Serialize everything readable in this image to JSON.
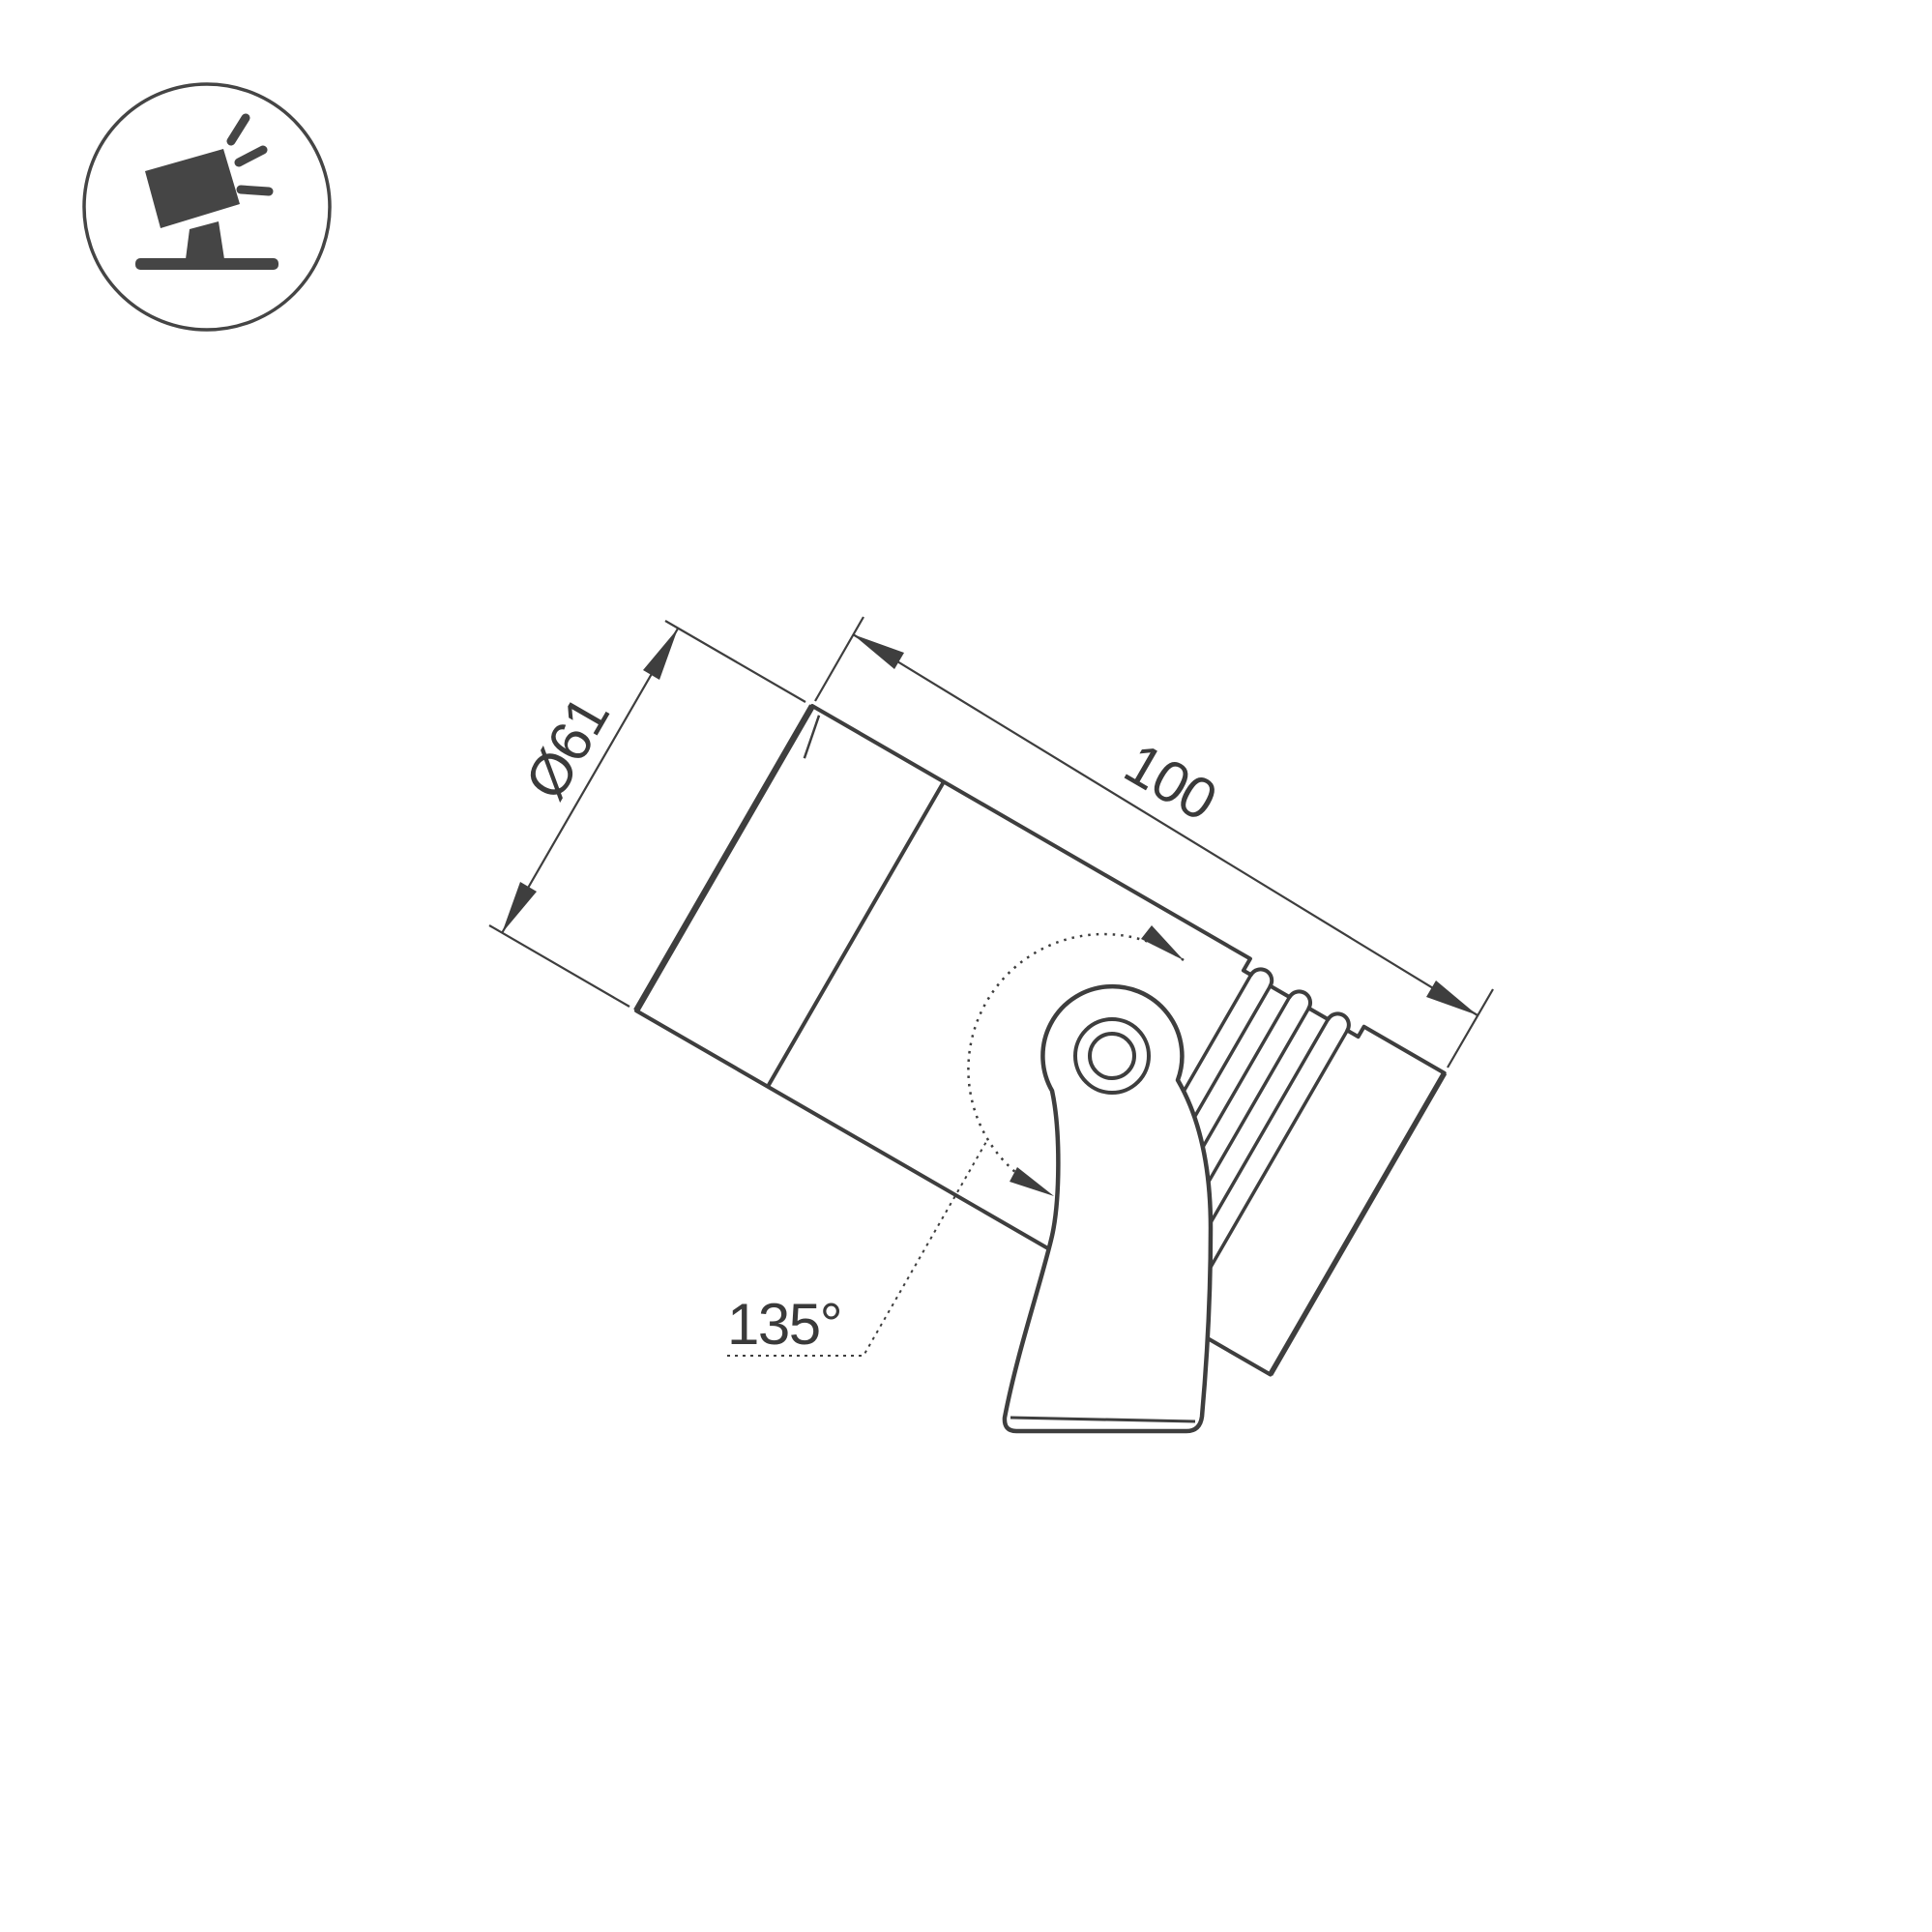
{
  "page": {
    "background_color": "#ffffff",
    "kind": "product-dimension-drawing"
  },
  "badge": {
    "icon": "tilted-spotlight-on-ground-icon",
    "color": "#454545"
  },
  "drawing": {
    "subject": "Tilted cylindrical LED spotlight with heatsink fins on a pivot mounting bracket, side view",
    "line_color": "#3e3e3e",
    "dimensions": {
      "diameter": {
        "label": "Ø61"
      },
      "length": {
        "label": "100"
      },
      "rotation_angle": {
        "label": "135°"
      }
    }
  }
}
